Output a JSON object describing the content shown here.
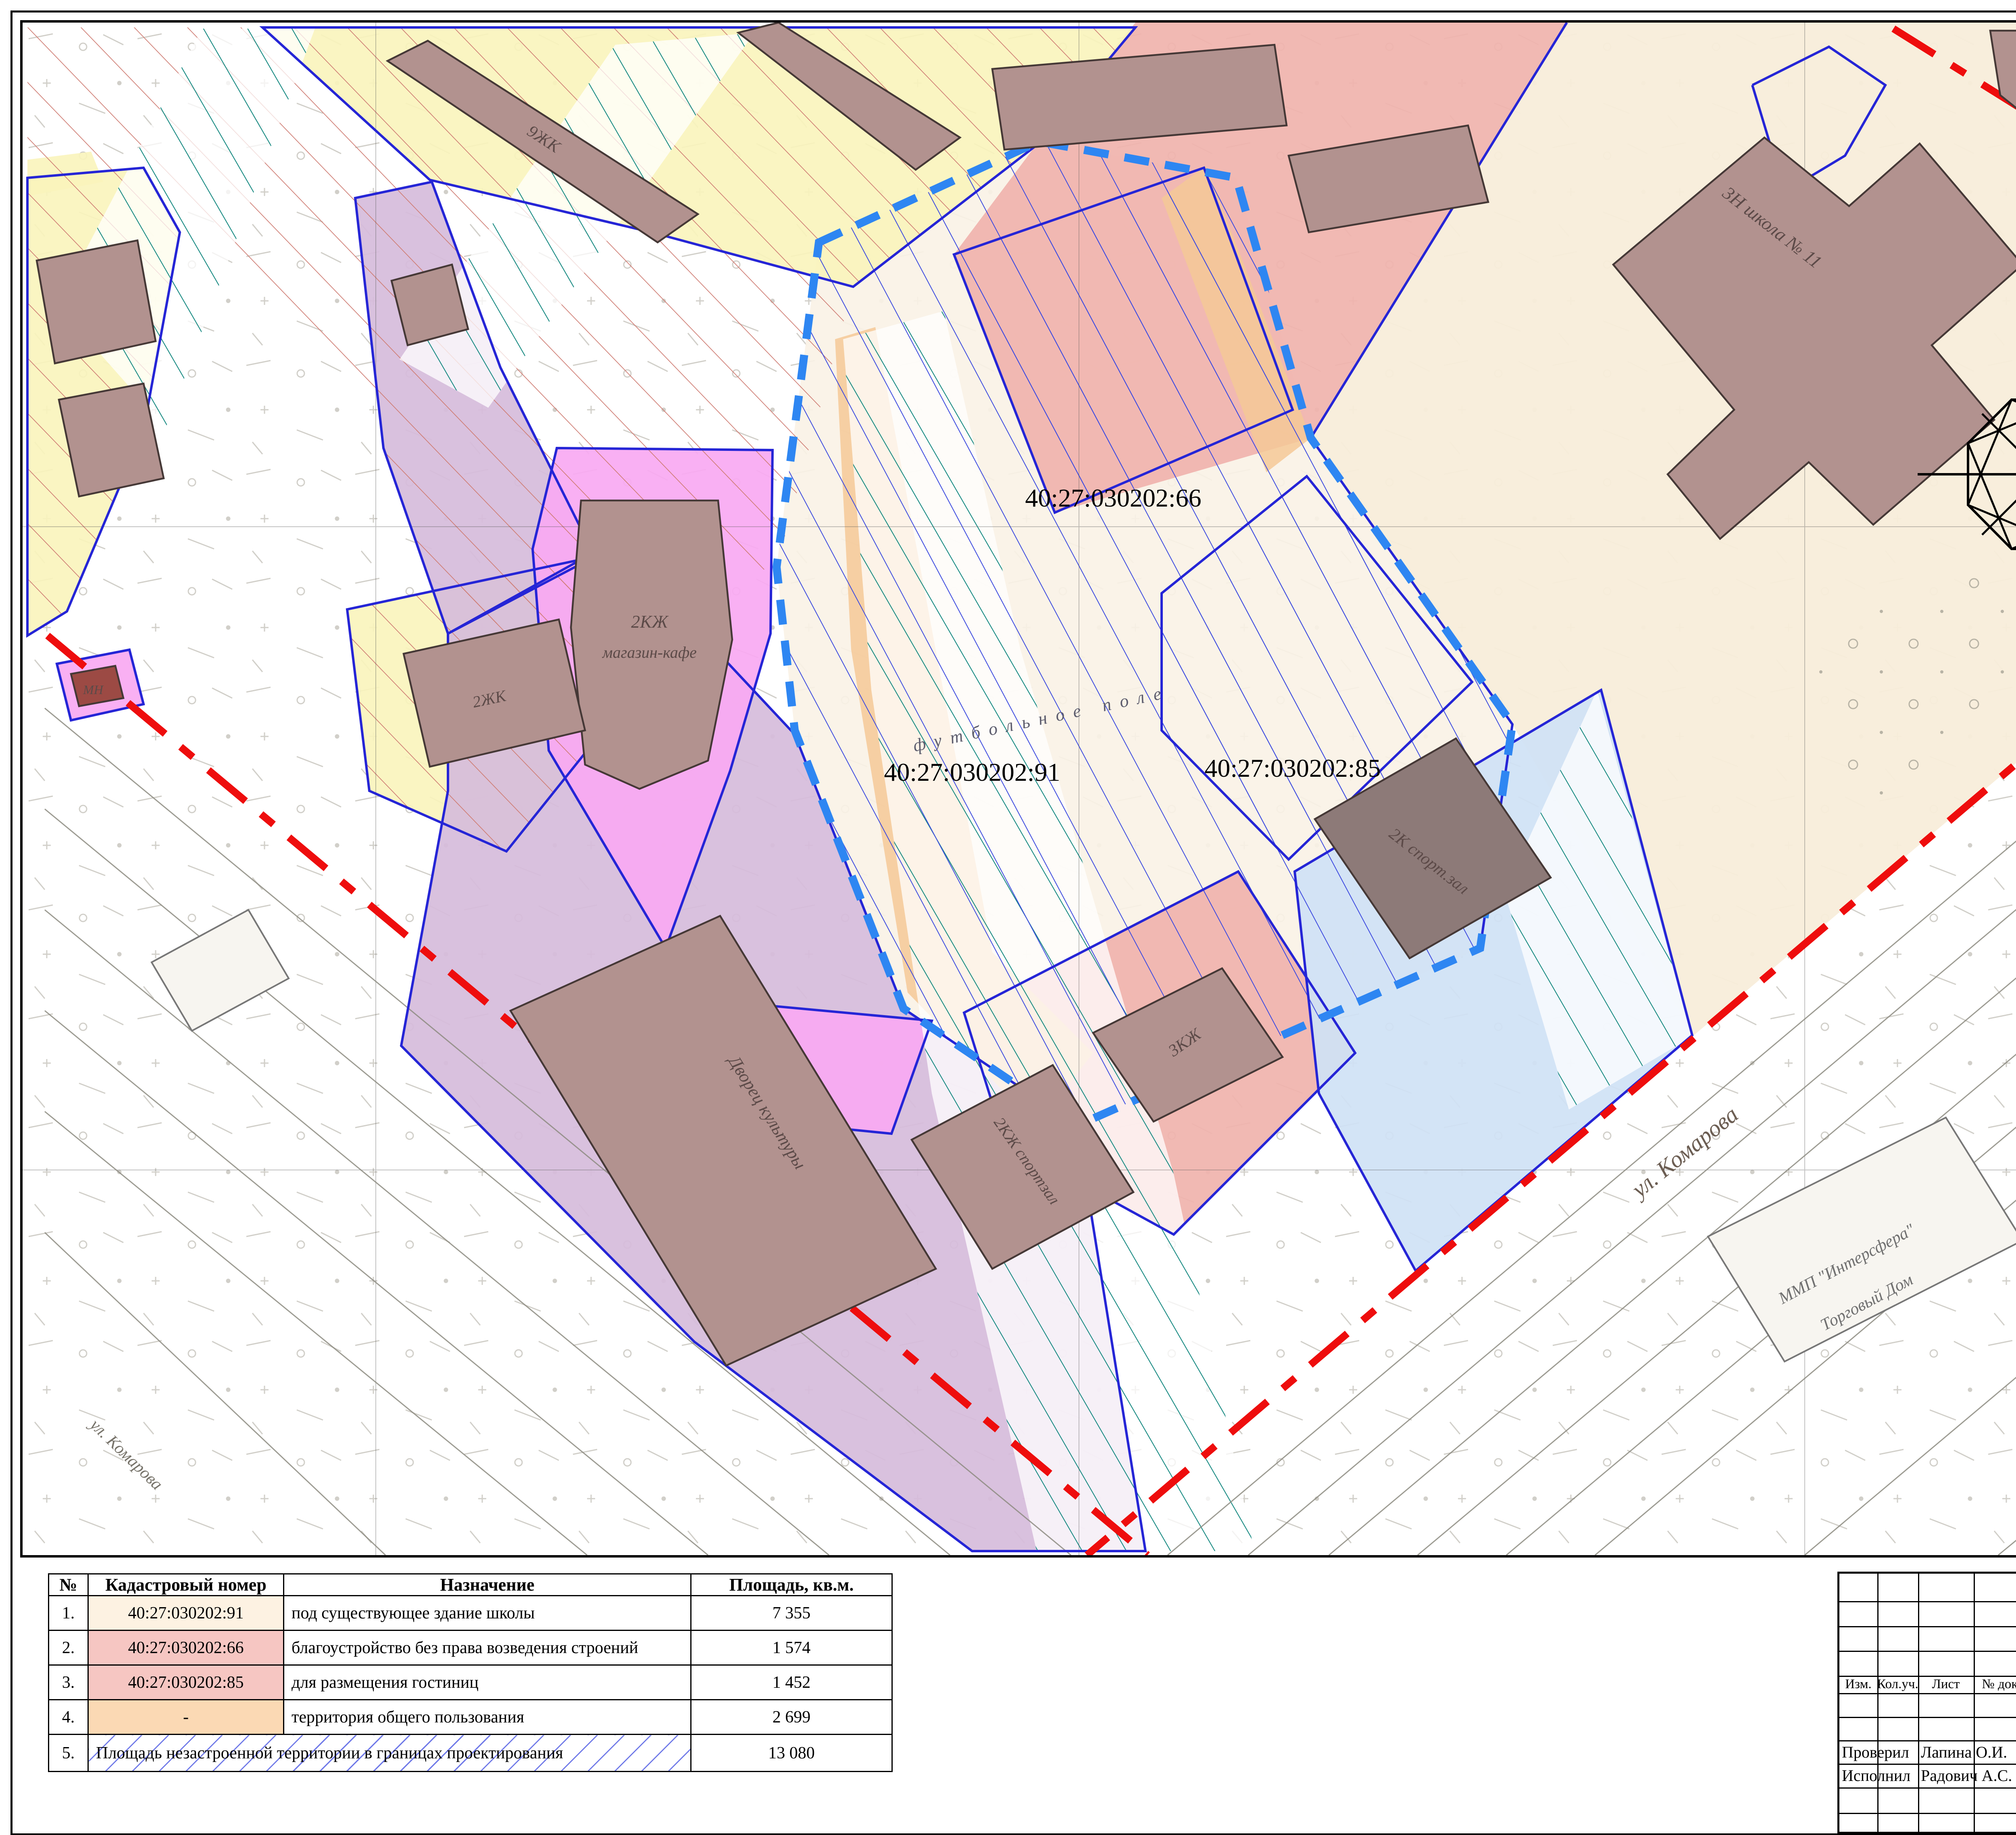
{
  "sheet": {
    "title_hint": "Чертеж использования территории (план)"
  },
  "colors": {
    "boundary_blue": "#2525d6",
    "project_boundary_blue": "#2e86f2",
    "red_line": "#ee0d0d",
    "building_brown": "#b2928f",
    "oks_swatch": "#b59a98",
    "zone_yellow": "#f9f4bb",
    "zone_culture": "#d6bcdb",
    "zone_admin": "#f0b3ad",
    "zone_sport": "#cfe2f5",
    "zone_trade": "#f9a9f2",
    "zone_education": "#f8edda",
    "teal_hatch": "#12877f",
    "blue_hatch": "#3f4ce0",
    "red_hatch": "#cf7d74"
  },
  "legend": {
    "title": "Условные обозначения:",
    "items": [
      {
        "label": "территория проектирования"
      },
      {
        "label": "границы земельных участков (сущ.)"
      },
      {
        "label": "красные линии"
      },
      {
        "label": "ОКС (сущ.)",
        "fill": "#b59a98"
      }
    ],
    "zoning_title": "Функциональное зонирование:",
    "zoning": [
      {
        "label": "жилые зоны (существующая застройка 32 мкр.)",
        "fill": "#ffffff"
      },
      {
        "label": "незастроенная территория",
        "fill": "#ffffff"
      },
      {
        "label": "зона объектов культуры",
        "fill": "#d6bcdb"
      },
      {
        "label": "зона административно-делового назначения",
        "fill": "#f0b3ad"
      },
      {
        "label": "зона объектов спортивного назначения",
        "fill": "#cfe2f5"
      },
      {
        "label": "зона объектов торговли и питания",
        "fill": "#f9a9f2"
      },
      {
        "label": "зона объектов образования (школа № 11)",
        "fill": "#f8edda"
      },
      {
        "label": "территория общего пользования",
        "fill": "#ffffff"
      }
    ]
  },
  "map": {
    "compass_letter": "С",
    "parcel_91": "40:27:030202:91",
    "parcel_85": "40:27:030202:85",
    "parcel_66": "40:27:030202:66",
    "street_komarova": "ул. Комарова",
    "street_komarova_2": "ул. Комарова",
    "football_field": "футбольное поле",
    "palace_of_culture": "Дворец культуры",
    "shop_cafe_line1": "2КЖ",
    "shop_cafe_line2": "магазин-кафе",
    "sport_hall_right": "2К спорт.зал",
    "sport_hall_center": "2КЖ спортзал",
    "bld_3kzh": "3КЖ",
    "bld_9zhk": "9ЖК",
    "bld_2zhk": "2ЖК",
    "school_label": "3Н школа № 11",
    "trade_house_line1": "ММП \"Интерсфера\"",
    "trade_house_line2": "Торговый Дом",
    "bld_mn": "МН"
  },
  "table": {
    "headers": [
      "№",
      "Кадастровый номер",
      "Назначение",
      "Площадь, кв.м."
    ],
    "rows": [
      {
        "num": "1.",
        "cadastral": "40:27:030202:91",
        "purpose": "под существующее здание школы",
        "area": "7 355",
        "cad_bg": "#fdf2e2"
      },
      {
        "num": "2.",
        "cadastral": "40:27:030202:66",
        "purpose": "благоустройство без права возведения строений",
        "area": "1 574",
        "cad_bg": "#f6c6c2"
      },
      {
        "num": "3.",
        "cadastral": "40:27:030202:85",
        "purpose": "для размещения гостиниц",
        "area": "1 452",
        "cad_bg": "#f6c6c2"
      },
      {
        "num": "4.",
        "cadastral": "-",
        "purpose": "территория общего пользования",
        "area": "2 699",
        "cad_bg": "#fbd9b4"
      },
      {
        "num": "5.",
        "merged": "Площадь незастроенной территории в границах проектирования",
        "area": "13 080"
      }
    ]
  },
  "titleblock": {
    "client": "Заказчик: Администрация МО \"Город Обнинск\"",
    "doc_number": "01/2017-001-ППТ",
    "project_line1": "Проект планировки и межевания незастроенной территории",
    "project_line2": "32-го микрорайона г. Обнинска",
    "cols": [
      "Изм.",
      "Кол.уч.",
      "Лист",
      "№ док.",
      "Подпись",
      "Дата"
    ],
    "materials": "Материалы по обоснованию",
    "stage_headers": [
      "Стадия",
      "Лист",
      "Листов"
    ],
    "stage_value": "ППТ",
    "checked_label": "Проверил",
    "checked_name": "Лапина О.И.",
    "executed_label": "Исполнил",
    "executed_name": "Радович А.С.",
    "drawing_title_line1": "Чертеж использования территории в период",
    "drawing_title_line2": "подготовки проекта планировки территории",
    "drawing_title_line3": "М 1:1000",
    "dept_line1": "Управление архитектуры и",
    "dept_line2": "градостроительства",
    "dept_line3": "Администрации города",
    "dept_line4": "Обнинска"
  }
}
